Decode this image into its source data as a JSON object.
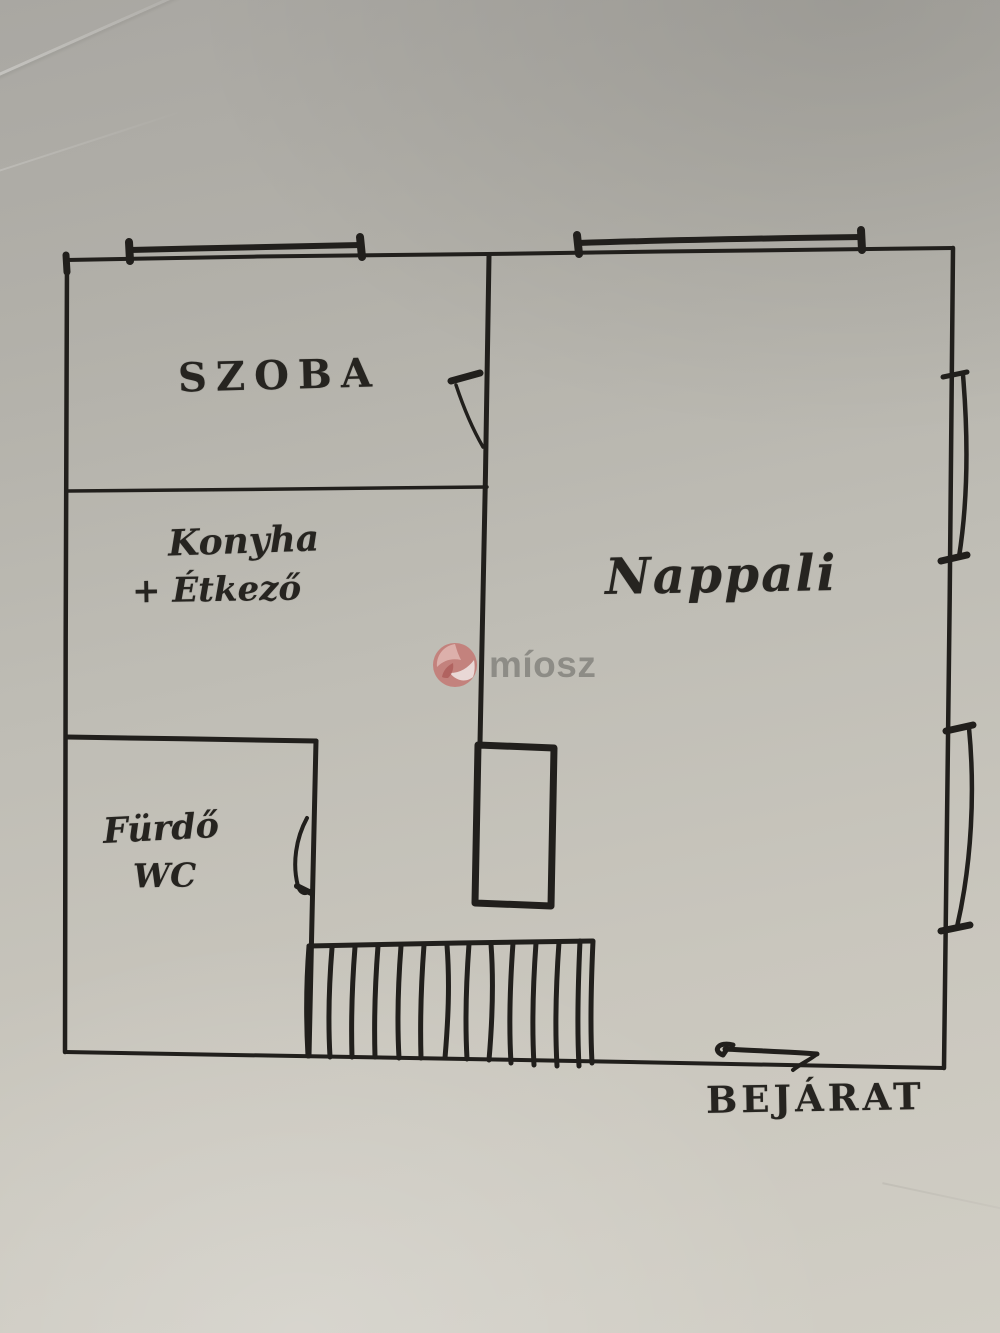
{
  "page": {
    "description": "Hand-drawn apartment floor plan sketch on scanned paper"
  },
  "floorplan": {
    "labels": {
      "szoba": "SZOBA",
      "konyha_line1": "Konyha",
      "konyha_line2": "+ Étkező",
      "nappali": "Nappali",
      "furdo_line1": "Fürdő",
      "furdo_line2": "WC",
      "bejarat": "BEJÁRAT"
    }
  },
  "watermark": {
    "text": "míosz",
    "logo_color": "#c4706c",
    "text_color": "#85847e"
  },
  "colors": {
    "ink": "#211f1c",
    "paper_top": "#a9a7a2",
    "paper_bottom": "#d1cec5"
  }
}
